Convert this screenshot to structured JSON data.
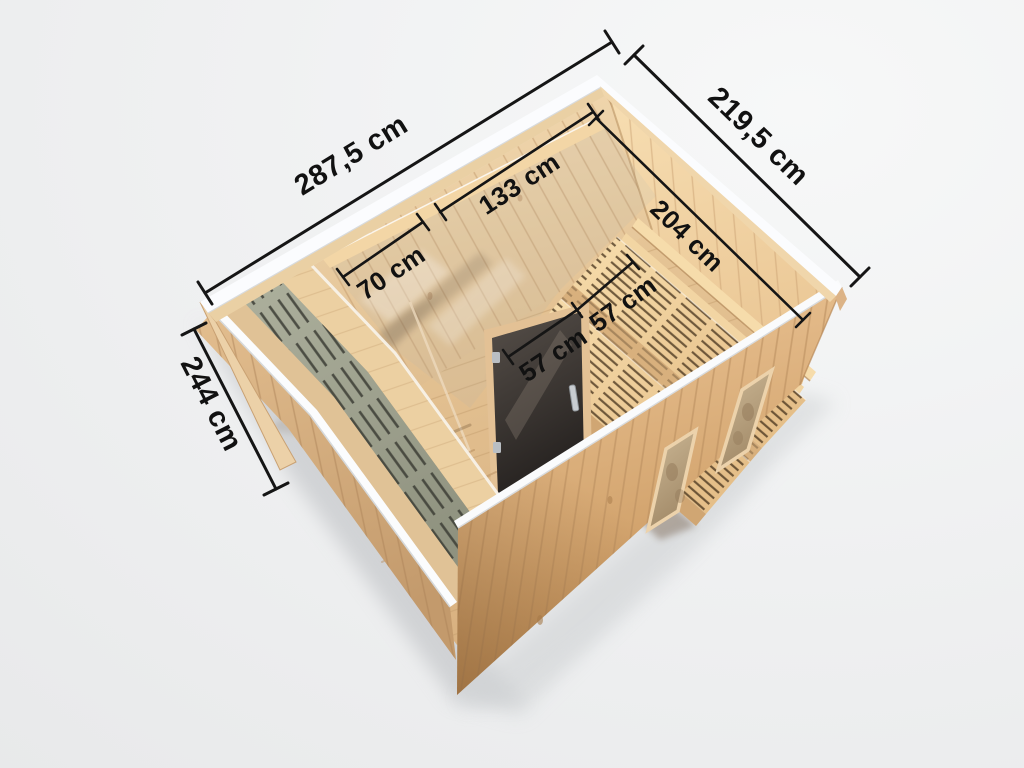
{
  "scene": {
    "description": "Isometric 3D cutaway rendering of a wooden sauna cabin seen from above with interior benches, glass door, glass front, terrace deck and two windows, annotated with dimension lines",
    "units": "cm"
  },
  "dimensions": [
    {
      "id": "overall-width",
      "label": "287,5 cm",
      "value_cm": 287.5,
      "location": "outer top-left edge"
    },
    {
      "id": "overall-depth",
      "label": "219,5 cm",
      "value_cm": 219.5,
      "location": "outer top-right edge"
    },
    {
      "id": "overall-height",
      "label": "244 cm",
      "value_cm": 244,
      "location": "outer left edge"
    },
    {
      "id": "sauna-room-width",
      "label": "133 cm",
      "value_cm": 133,
      "location": "interior back wall"
    },
    {
      "id": "sauna-room-depth",
      "label": "204 cm",
      "value_cm": 204,
      "location": "interior right wall"
    },
    {
      "id": "anteroom-width",
      "label": "70 cm",
      "value_cm": 70,
      "location": "interior left partition"
    },
    {
      "id": "bench-depth-lower",
      "label": "57 cm",
      "value_cm": 57,
      "location": "lower bench"
    },
    {
      "id": "bench-depth-upper",
      "label": "57 cm",
      "value_cm": 57,
      "location": "upper bench"
    }
  ],
  "colors": {
    "background": "#eff0f1",
    "rim_white": "#fbfcfe",
    "wood_light": "#f2d9b2",
    "wood_mid": "#e2bb8c",
    "wood_dark": "#c0905d",
    "deck_green": "#a8ab99",
    "glass_dark": "#35302b",
    "heater_red": "#7a3420",
    "dimension_line": "#151515"
  }
}
